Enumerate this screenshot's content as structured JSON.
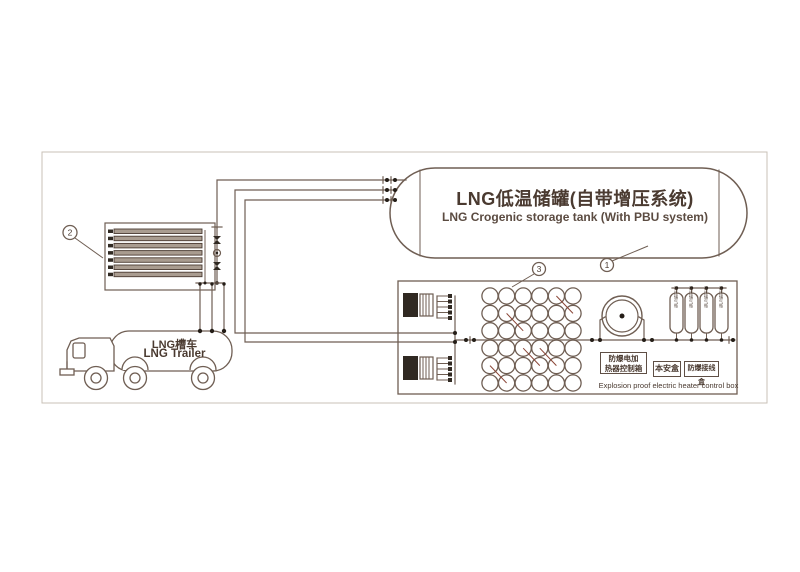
{
  "colors": {
    "line": "#6f5e53",
    "border": "#c9c1b7",
    "text": "#4a3a30",
    "dark_fill": "#302922",
    "accent": "#8a4536",
    "background": "#ffffff"
  },
  "tank": {
    "title_cn": "LNG低温储罐(自带增压系统)",
    "title_en": "LNG Crogenic storage tank (With PBU system)"
  },
  "trailer": {
    "label_cn": "LNG槽车",
    "label_en": "LNG Trailer"
  },
  "skid": {
    "heater_box_line1": "防爆电加",
    "heater_box_line2": "热器控制箱",
    "safety_box_label": "本安盒",
    "junction_box_label": "防爆接线盒",
    "caption": "Explosion proof electric heater control box",
    "cylinder_label": "高压储气瓶"
  },
  "callouts": {
    "tank_no": "1",
    "vaporizer_no": "2",
    "coil_no": "3"
  }
}
